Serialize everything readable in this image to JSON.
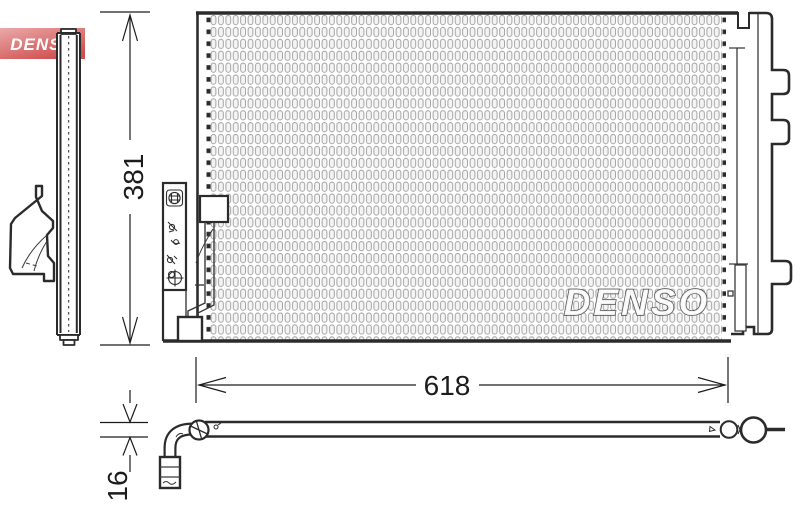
{
  "drawing": {
    "kind": "technical-part-drawing",
    "part": "air-conditioning condenser",
    "views": [
      "side-view",
      "front-view",
      "top-view"
    ]
  },
  "logo": {
    "text": "DENSO",
    "bg_top": "#eaa9a9",
    "bg_bottom": "#d04e4e",
    "text_color": "#ffffff"
  },
  "watermark": {
    "text": "DENSO"
  },
  "dimensions": {
    "height": "381",
    "width": "618",
    "depth": "16"
  },
  "icons": [
    "sight-glass-grid-icon",
    "bolt-icon",
    "clip-icon",
    "valve-port-icon",
    "port-cross-icon",
    "drier-cap-icon"
  ],
  "colors": {
    "line": "#2b2b2b",
    "thin_line": "#3a3a3a",
    "fin_gray": "#9b9b9b",
    "background": "#ffffff"
  }
}
